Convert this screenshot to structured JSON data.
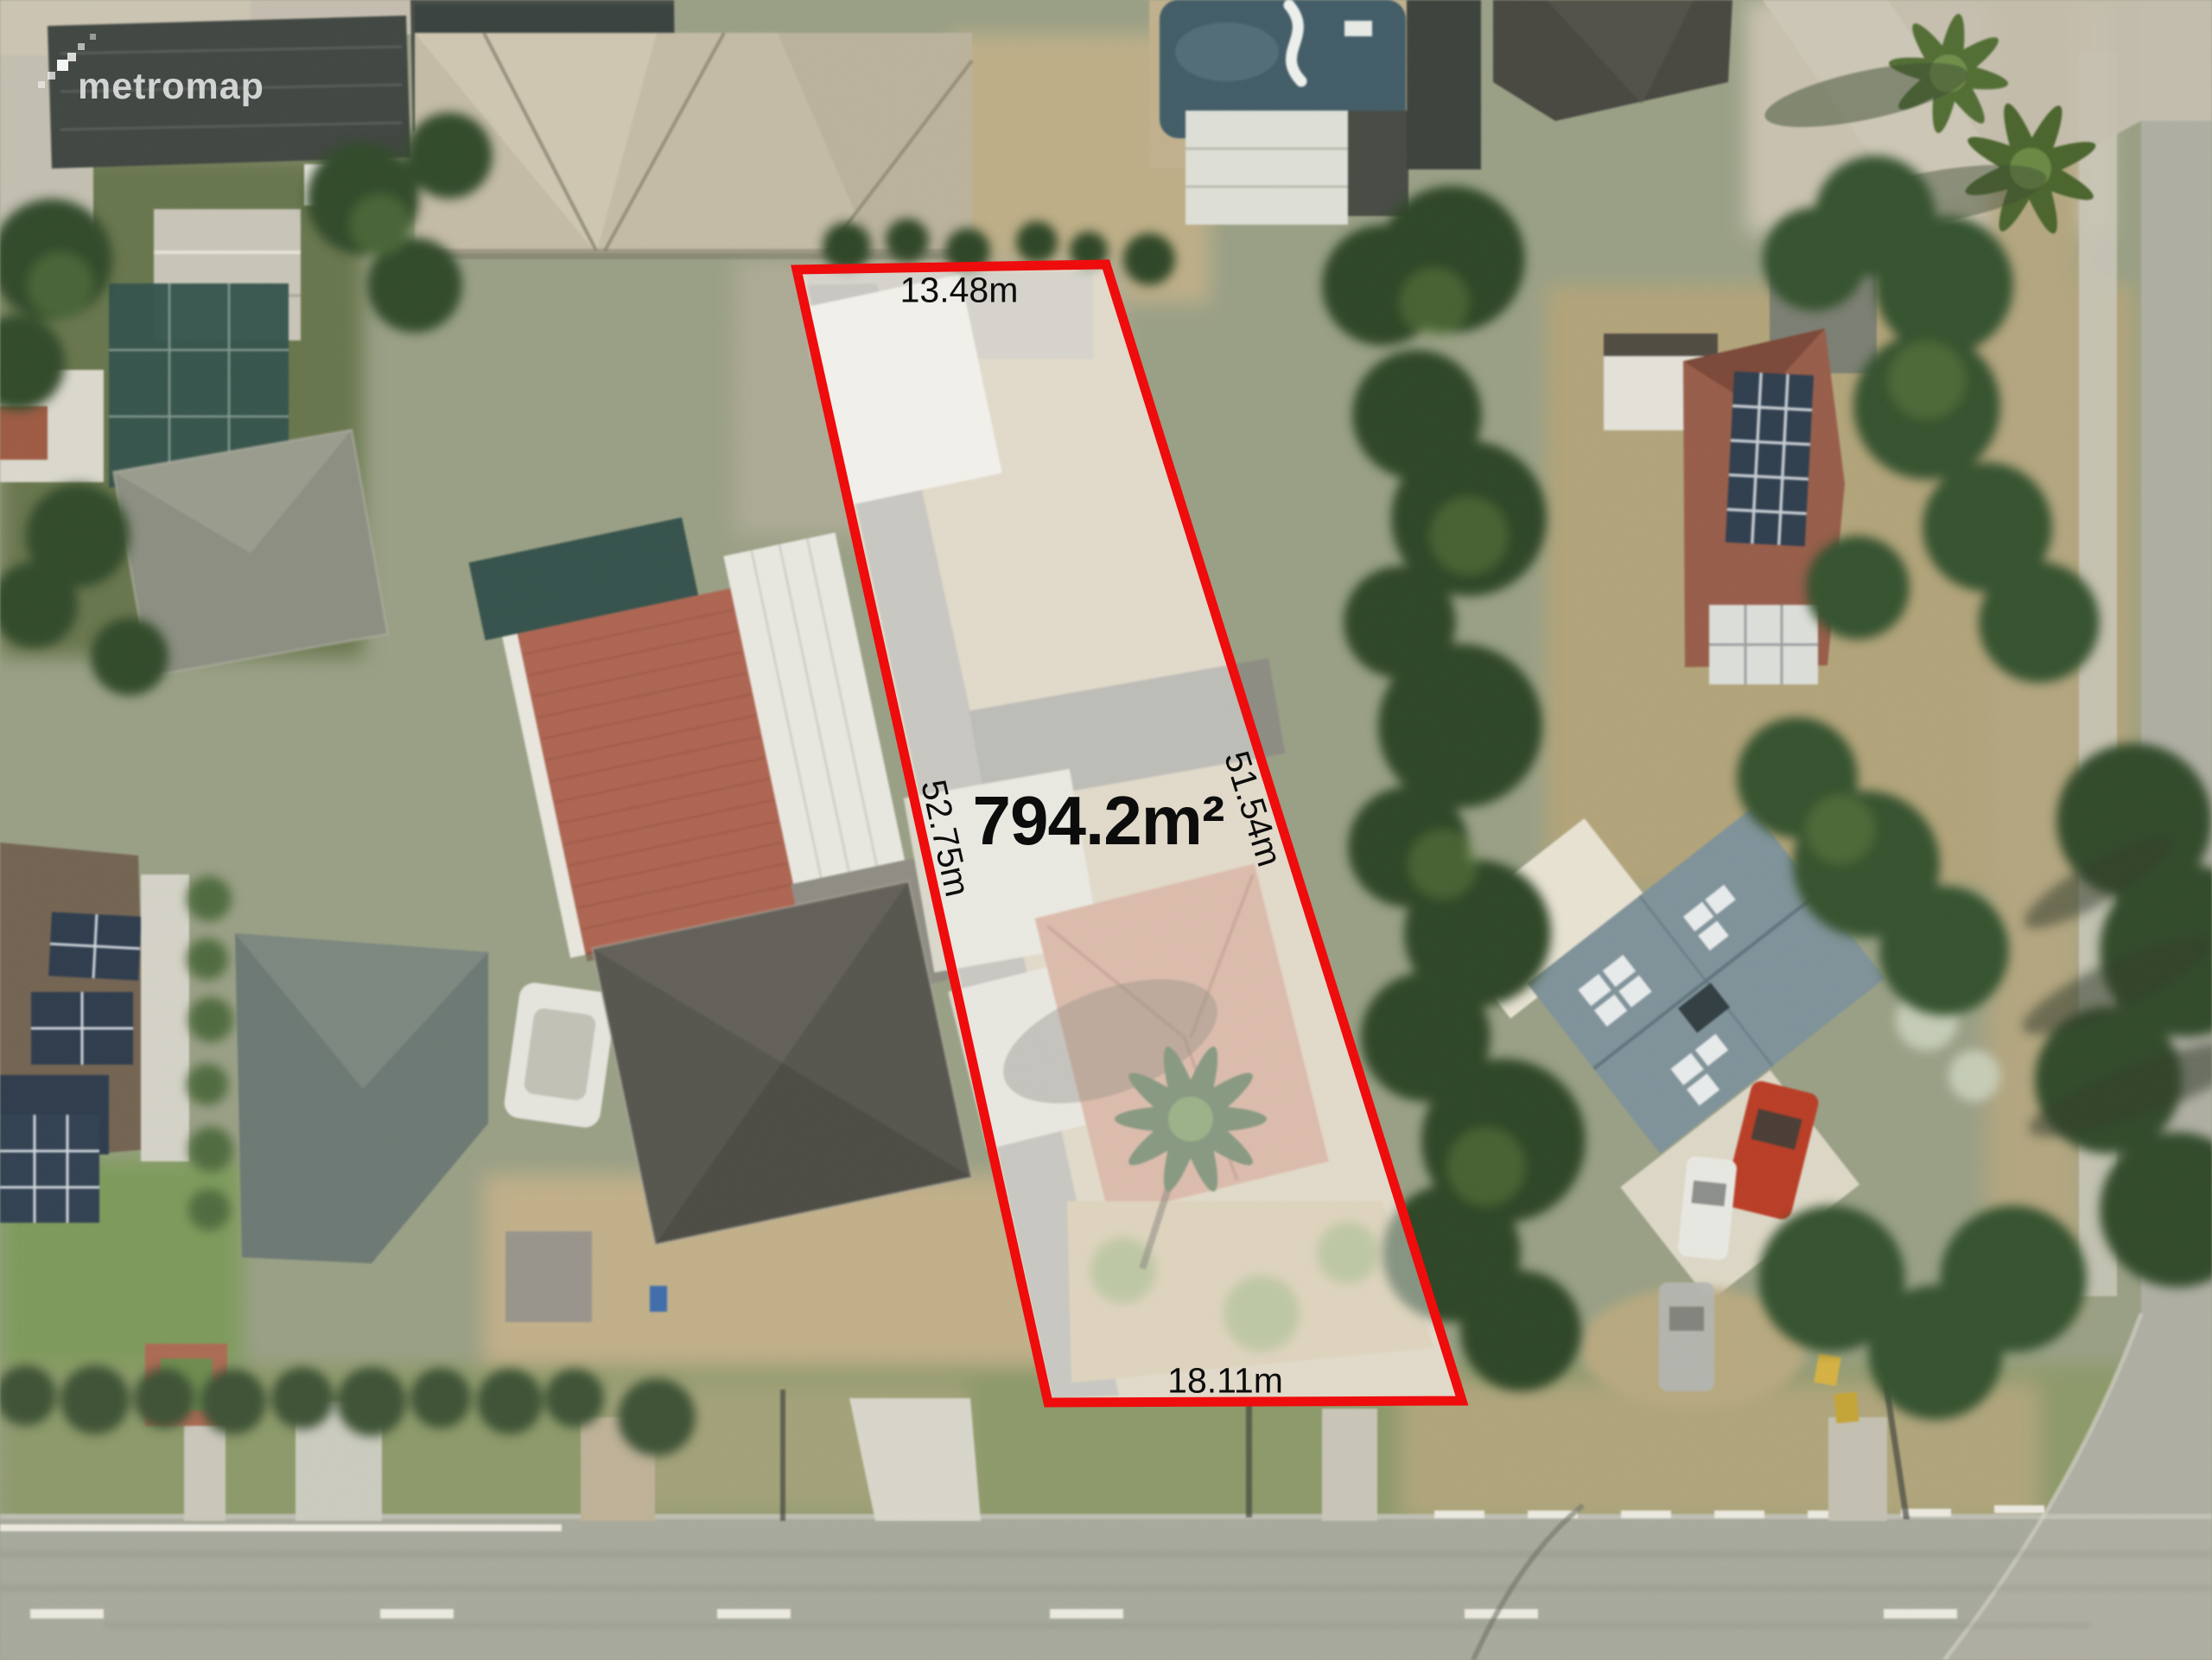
{
  "watermark": {
    "text": "metromap"
  },
  "parcel": {
    "area_label": "794.2m²",
    "side_top": "13.48m",
    "side_left": "52.75m",
    "side_right": "51.54m",
    "side_bottom": "18.11m",
    "outline_color": "#ee0c0c",
    "fill_color": "rgba(255,255,255,0.42)"
  }
}
